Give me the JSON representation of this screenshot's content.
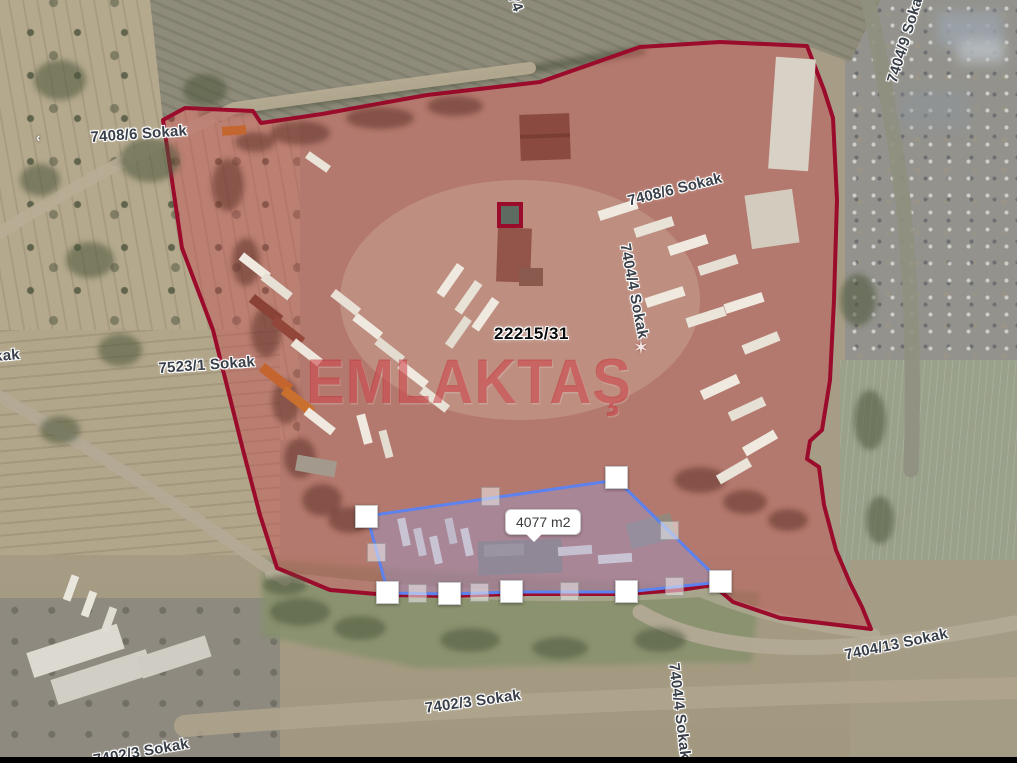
{
  "map": {
    "parcel_label": "22215/31",
    "selection": {
      "area_label": "4077 m2"
    },
    "watermark": {
      "text": "EMLAKTAŞ",
      "star_icon": "✶"
    },
    "road_arrow": "‹",
    "street_labels": [
      {
        "id": "top-left",
        "text": "7408/6 Sokak"
      },
      {
        "id": "top-right-vertical",
        "text": "7404/9 Sokak"
      },
      {
        "id": "top-center-partial",
        "text": "74"
      },
      {
        "id": "inside-parcel-upper",
        "text": "7408/6 Sokak"
      },
      {
        "id": "inside-parcel-vertical",
        "text": "7404/4 Sokak"
      },
      {
        "id": "left-edge-partial",
        "text": "Sokak"
      },
      {
        "id": "mid-left",
        "text": "7523/1 Sokak"
      },
      {
        "id": "bottom-right-diagonal",
        "text": "7404/13 Sokak"
      },
      {
        "id": "bottom-center",
        "text": "7402/3 Sokak"
      },
      {
        "id": "bottom-right-vertical",
        "text": "7404/4 Sokak"
      },
      {
        "id": "bottom-left",
        "text": "7402/3 Sokak"
      }
    ],
    "colors": {
      "parcel_outline": "#9b0b2b",
      "parcel_fill": "rgba(201,68,74,0.40)",
      "selection_outline": "#5d82ee",
      "selection_fill": "rgba(155,150,200,0.45)"
    }
  }
}
